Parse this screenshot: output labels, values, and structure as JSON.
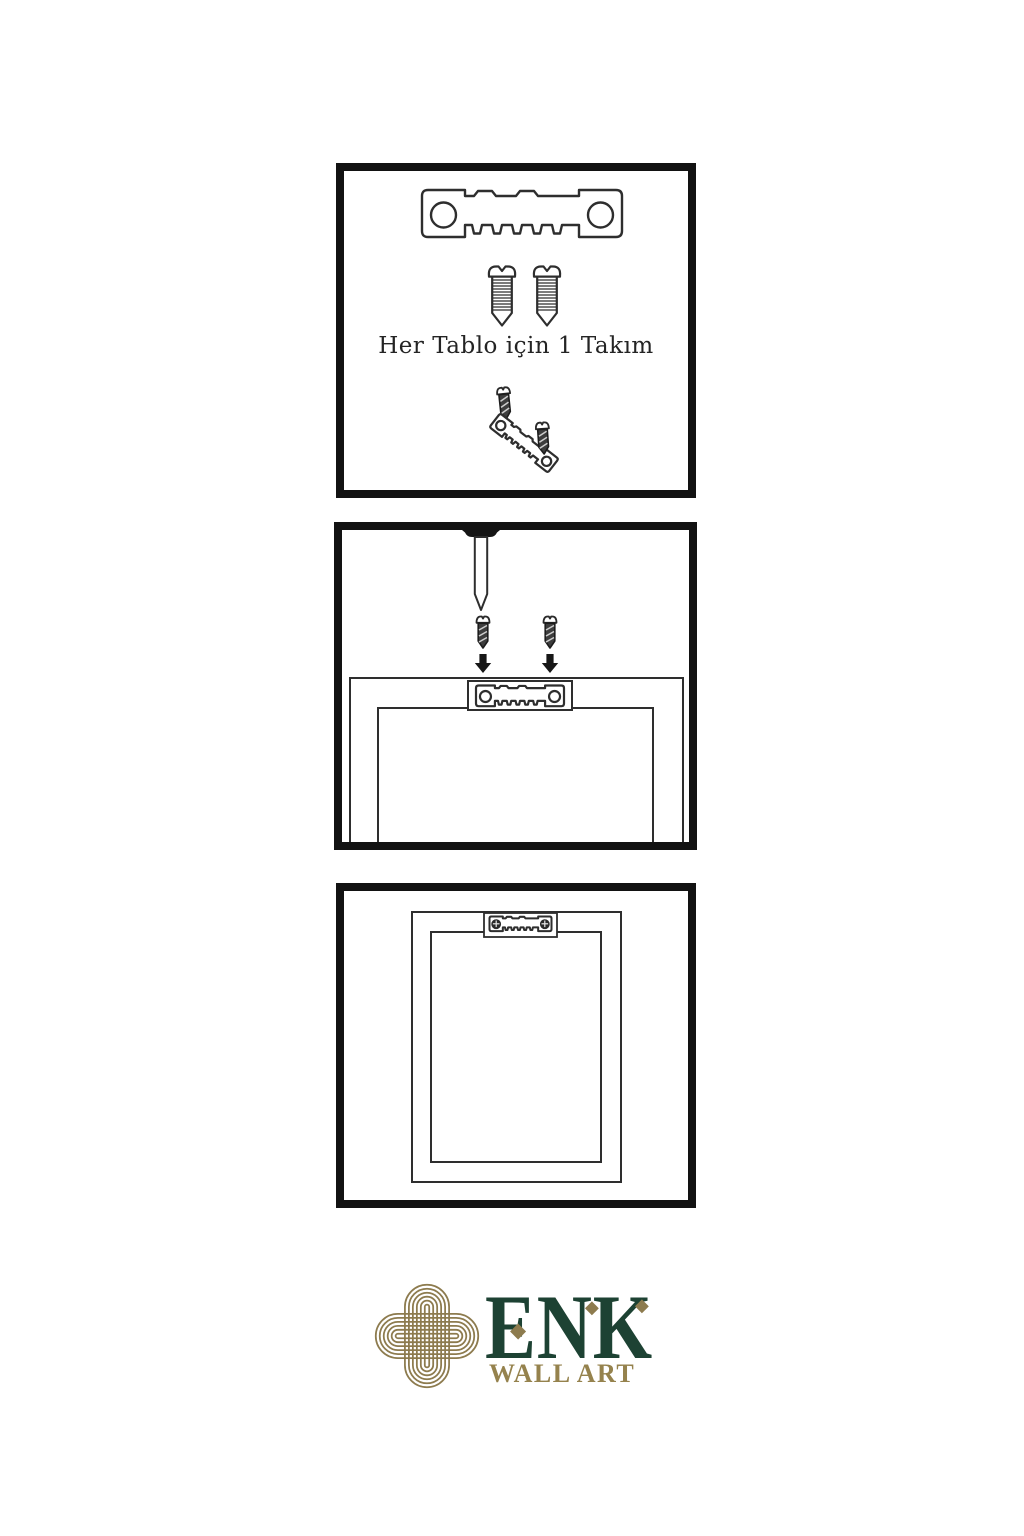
{
  "page": {
    "background_color": "#ffffff"
  },
  "colors": {
    "line_ink": "#2e2e2e",
    "panel_border": "#121212",
    "logo_gold": "#8d7b4e",
    "logo_green": "#1d4233"
  },
  "panels": [
    {
      "step": 1,
      "caption": "Her Tablo için 1 Takım",
      "contents": [
        "sawtooth-hanger",
        "screw",
        "screw",
        "angled-hanger-with-two-screws"
      ]
    },
    {
      "step": 2,
      "caption": "",
      "contents": [
        "screwdriver-tip",
        "screw-with-down-arrow",
        "screw-with-down-arrow",
        "frame-back-top-edge",
        "mounted-sawtooth-hanger"
      ]
    },
    {
      "step": 3,
      "caption": "",
      "contents": [
        "frame-back",
        "installed-sawtooth-hanger-with-screws"
      ]
    }
  ],
  "logo": {
    "brand": "ENK",
    "subtitle": "WALL ART",
    "mark": "interlaced-knot"
  }
}
